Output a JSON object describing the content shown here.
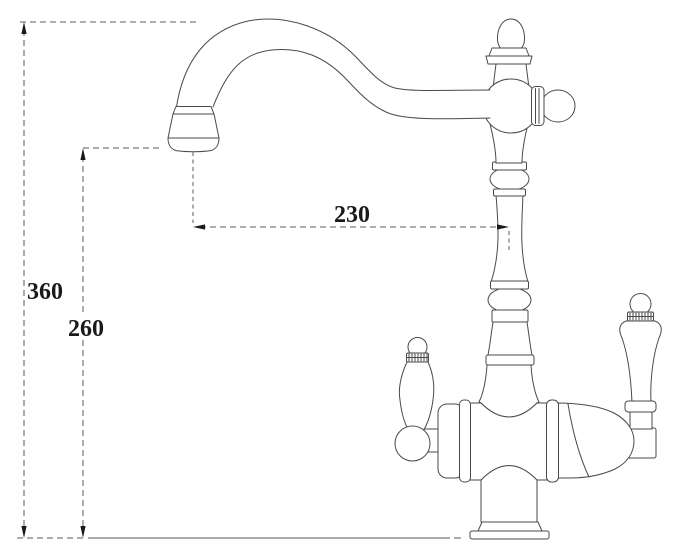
{
  "diagram": {
    "dimensions": {
      "overall_height": {
        "label": "360"
      },
      "spout_outlet_height": {
        "label": "260"
      },
      "spout_reach": {
        "label": "230"
      }
    },
    "colors": {
      "background": "#ffffff",
      "outline": "#4a4a4a",
      "dimension_line": "#5a5a5a",
      "dimension_text": "#1a1a1a"
    }
  }
}
